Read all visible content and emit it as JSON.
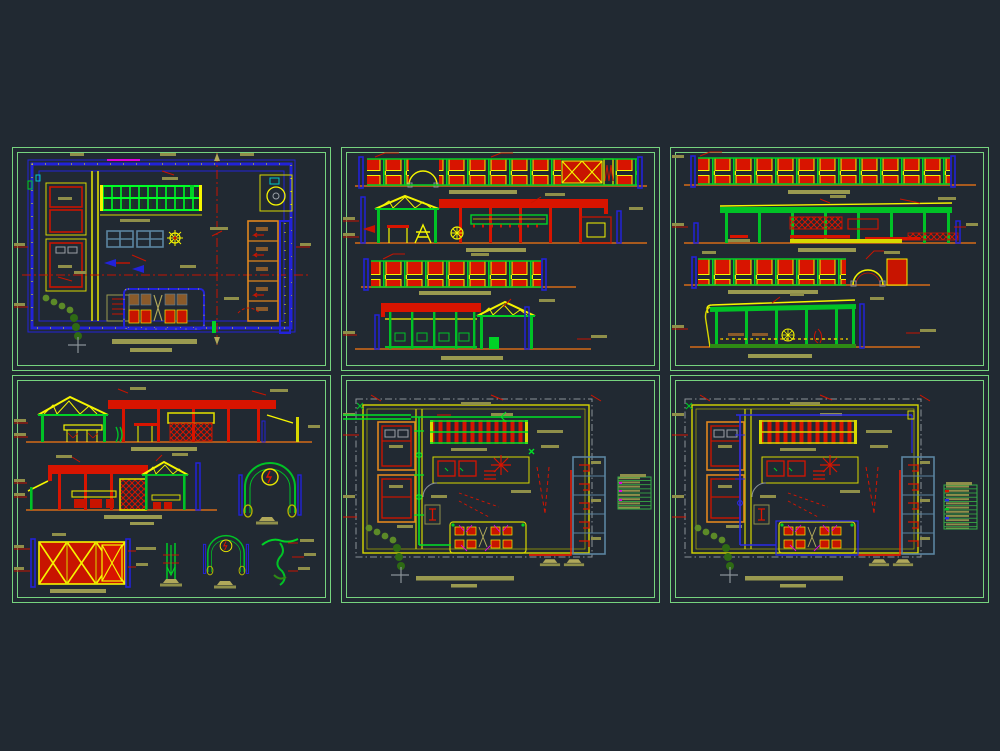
{
  "app": {
    "description": "CAD drawing canvas showing six architectural sheets (plans, elevations, sections, details, installation plans)",
    "background_color": "#212932",
    "sheet_border_color": "#76d37e"
  },
  "palette": {
    "red": "#d81400",
    "bright_red": "#ff1a00",
    "yellow": "#f5f500",
    "green": "#00d226",
    "dark_green": "#2e6a14",
    "olive_tree": "#5c8a28",
    "blue": "#2222d8",
    "steel_blue": "#5b84a0",
    "orange": "#e0861e",
    "brown_baseline": "#a85a1e",
    "khaki_annotation": "#8f8f4a",
    "magenta": "#e000e0",
    "cyan": "#00c8c8",
    "gray": "#8a9298"
  },
  "sheets": [
    {
      "id": "plan-general",
      "kind": "floor plan with furniture, skylight grid, service rooms and benches",
      "row": 1,
      "col": 1
    },
    {
      "id": "elevations-a",
      "kind": "four elevations: fence with arch, main building section, fence, covered patio",
      "row": 1,
      "col": 2
    },
    {
      "id": "elevations-b",
      "kind": "four elevations: long fence, longitudinal section, fence with arch, lateral section",
      "row": 1,
      "col": 3
    },
    {
      "id": "sections-details",
      "kind": "two building sections, gate detail, post detail, two arch details, vine detail",
      "row": 2,
      "col": 1
    },
    {
      "id": "installations-green",
      "kind": "installation floor plan with green piping and legend table",
      "row": 2,
      "col": 2
    },
    {
      "id": "installations-blue",
      "kind": "installation floor plan with blue piping and legend table",
      "row": 2,
      "col": 3
    }
  ],
  "legend_tables": {
    "count": 2,
    "appearance": "small green-ruled tables with khaki text bars and colored key symbols (text illegible at this scale)"
  },
  "annotations": {
    "note": "All dimension text, leaders and sheet titles are sub-pixel khaki bars (illegible); no readable strings present in the screenshot."
  }
}
